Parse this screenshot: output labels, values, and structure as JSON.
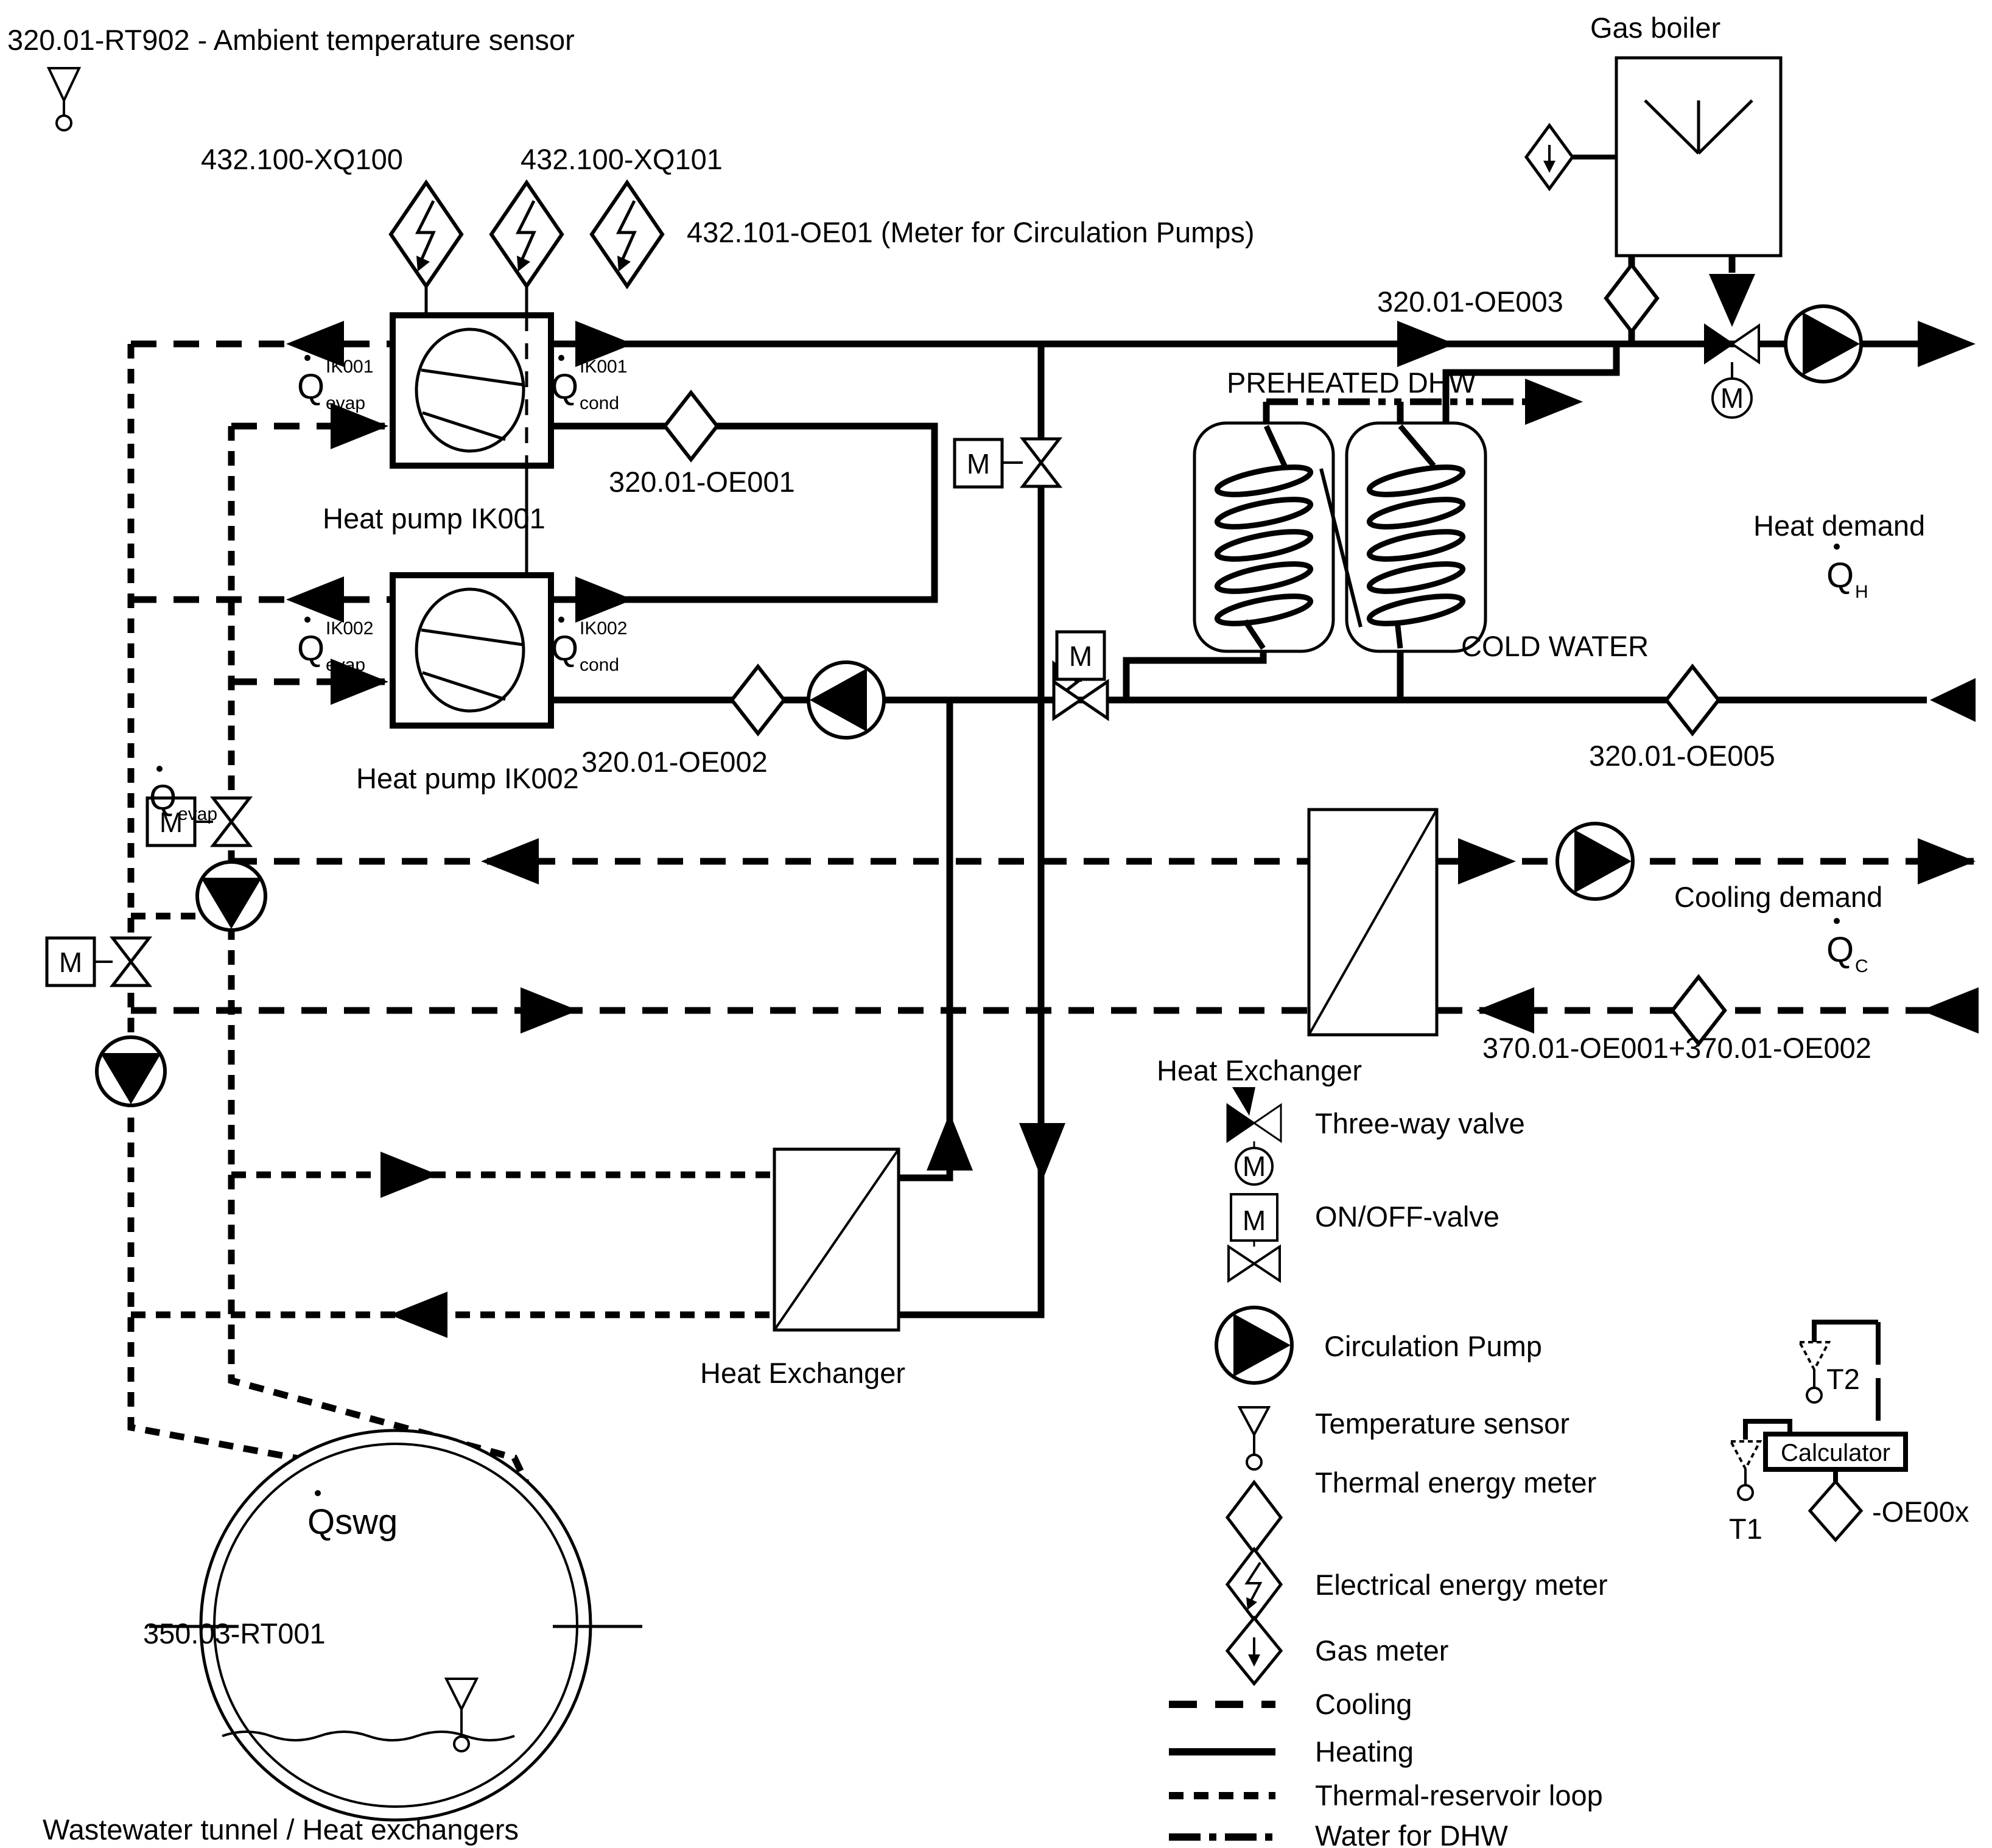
{
  "colors": {
    "ink": "#000000",
    "bg": "#ffffff"
  },
  "symbols": {
    "m": "M"
  },
  "labels": {
    "ambient_sensor": "320.01-RT902 - Ambient temperature sensor",
    "xq100": "432.100-XQ100",
    "xq101": "432.100-XQ101",
    "oe01_pumps": "432.101-OE01 (Meter for Circulation Pumps)",
    "gas_boiler": "Gas boiler",
    "oe003": "320.01-OE003",
    "preheated_dhw": "PREHEATED DHW",
    "cold_water": "COLD WATER",
    "oe005": "320.01-OE005",
    "heat_demand": "Heat demand",
    "cooling_demand": "Cooling demand",
    "oe_sum": "370.01-OE001+370.01-OE002",
    "hx_right": "Heat Exchanger",
    "hx_bottom": "Heat Exchanger",
    "hp1": "Heat pump IK001",
    "hp2": "Heat pump IK002",
    "oe001": "320.01-OE001",
    "oe002": "320.01-OE002",
    "qswg": "Qswg",
    "rt001": "350.03-RT001",
    "wastewater": "Wastewater tunnel / Heat exchangers",
    "t1": "T1",
    "t2": "T2",
    "calculator": "Calculator",
    "oe00x": "-OE00x"
  },
  "q_labels": {
    "q": "Q",
    "evap1_sup": "IK001",
    "evap1_sub": "evap",
    "cond1_sup": "IK001",
    "cond1_sub": "cond",
    "evap2_sup": "IK002",
    "evap2_sub": "evap",
    "cond2_sup": "IK002",
    "cond2_sub": "cond",
    "evap_left_sub": "evap",
    "qh_sub": "H",
    "qc_sub": "C"
  },
  "legend": {
    "items": [
      {
        "name": "three-way-valve",
        "label": "Three-way valve"
      },
      {
        "name": "on-off-valve",
        "label": "ON/OFF-valve"
      },
      {
        "name": "circulation-pump",
        "label": "Circulation Pump"
      },
      {
        "name": "temperature-sensor",
        "label": "Temperature sensor"
      },
      {
        "name": "thermal-energy-meter",
        "label": "Thermal energy meter"
      },
      {
        "name": "electrical-energy-meter",
        "label": "Electrical energy meter"
      },
      {
        "name": "gas-meter",
        "label": "Gas meter"
      }
    ],
    "lines": [
      {
        "name": "cooling",
        "label": "Cooling"
      },
      {
        "name": "heating",
        "label": "Heating"
      },
      {
        "name": "thermal-reservoir-loop",
        "label": "Thermal-reservoir loop"
      },
      {
        "name": "water-for-dhw",
        "label": "Water for DHW"
      }
    ]
  }
}
